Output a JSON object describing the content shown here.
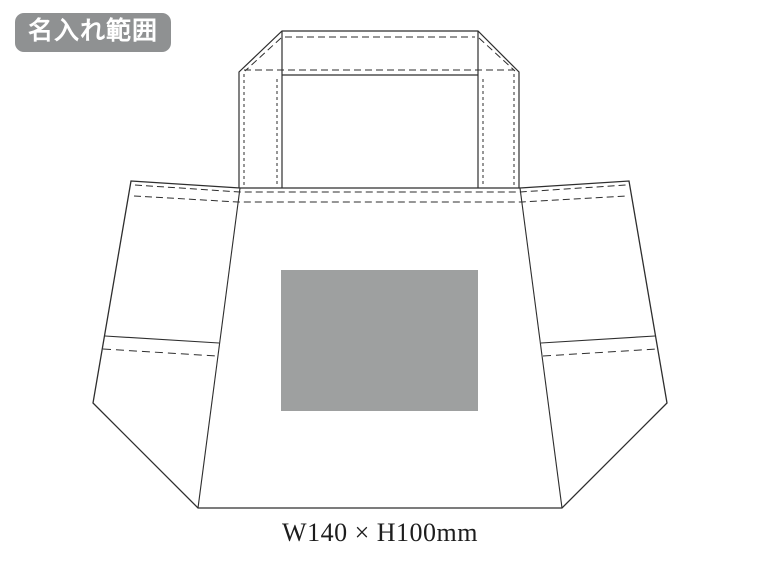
{
  "badge": {
    "label": "名入れ範囲",
    "bg_color": "#8f9192",
    "text_color": "#ffffff"
  },
  "diagram": {
    "description": "tote-bag imprint-area technical drawing",
    "line_color": "#2e2e2e",
    "dimension_label": "W140 × H100mm",
    "imprint_area": {
      "fill_color": "#9ea0a0",
      "width_mm": 140,
      "height_mm": 100
    }
  }
}
